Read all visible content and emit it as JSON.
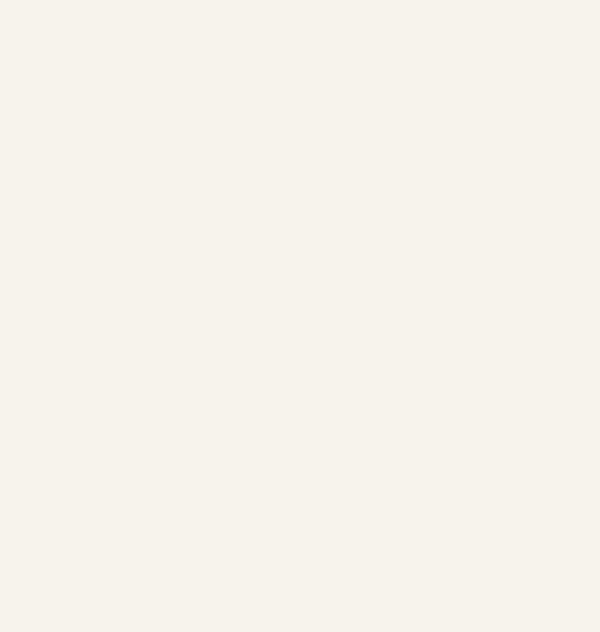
{
  "scene": {
    "type": "3d-architectural-exterior-render",
    "view": "aerial-isometric",
    "subject": "modern L-shaped villa with courtyard swimming pool, roof deck, pergola and landscaped plot",
    "background": "white"
  },
  "counts": {
    "cypress_trees": 26,
    "pergola_slats": 9,
    "dining_chairs": 8,
    "roof_loungers": 2,
    "pool_loungers": 2,
    "wood_loungers": 2,
    "pool_steps": 3,
    "street_lamps": 3,
    "path_lamps": 2,
    "grass_tufts": 5,
    "corten_fence_panels": 9,
    "timber_fence_panels": 7,
    "parked_cars": 2,
    "ball_bushes": 6
  },
  "elements": [
    "street-pavement",
    "gravel-path",
    "driveway",
    "parcel-terrace",
    "vineyard-nw",
    "vineyard-se",
    "planting-strip-ne",
    "tropical-garden",
    "gravel-bed",
    "cypress-hedge",
    "corten-fence",
    "timber-fence",
    "dark-privacy-fence",
    "parked-car",
    "swimming-pool",
    "pool-steps",
    "pool-loungers",
    "parasol-lounge",
    "bistro-set",
    "pergola",
    "villa-roof-deck",
    "dining-set",
    "hot-tub",
    "outdoor-kitchen",
    "entrance-canopy",
    "stone-staircase",
    "main-roof-block",
    "stone-feature-wall",
    "garden-trees",
    "ball-bushes",
    "grass-tufts",
    "street-lamps"
  ],
  "colors": {
    "bg": "#f7f3ec",
    "terrace": "#cdc5b4",
    "deck": "#d8d0c2",
    "roof_gray": "#b4b1ab",
    "white_wall": "#f7f5f1",
    "wall_shade": "#e8e5df",
    "stone": "#8d8170",
    "stone_cap": "#cfc2a8",
    "travertine": "#d9caa6",
    "soil_nw": "#7a5a3c",
    "soil_se": "#66492f",
    "crop_green": "#5a8538",
    "crop_green2": "#6d9a45",
    "hedge_green": "#3f5d33",
    "hedge_green2": "#49682f",
    "tree_green": "#64903f",
    "tree_green2": "#547c34",
    "tree_light": "#8cb35e",
    "olive_shrub": "#7e8f63",
    "corten": "#6f4b2d",
    "timber": "#7c5737",
    "dark_fence": "#34383b",
    "street_gray": "#a7a39b",
    "street_tan": "#c19d79",
    "path_gray": "#b4b0a7",
    "path_tan": "#bb8f63",
    "gravel_white": "#eae6db",
    "pool_rim": "#5fb6ae",
    "pool_light": "#c4ebe4",
    "pool_deep": "#a5dcd5",
    "step_light": "#e7f5f1",
    "teal_chair": "#74c0b8",
    "tub_dark": "#26292c",
    "tub_water": "#7ad2d4",
    "wood_lounger": "#b99b6e",
    "parasol": "#ddcba4",
    "lamp_dark": "#2f343a",
    "car_gray": "#9aa0a5",
    "glass_dark": "#3c4043",
    "grass_tuft": "#6b7f42"
  }
}
